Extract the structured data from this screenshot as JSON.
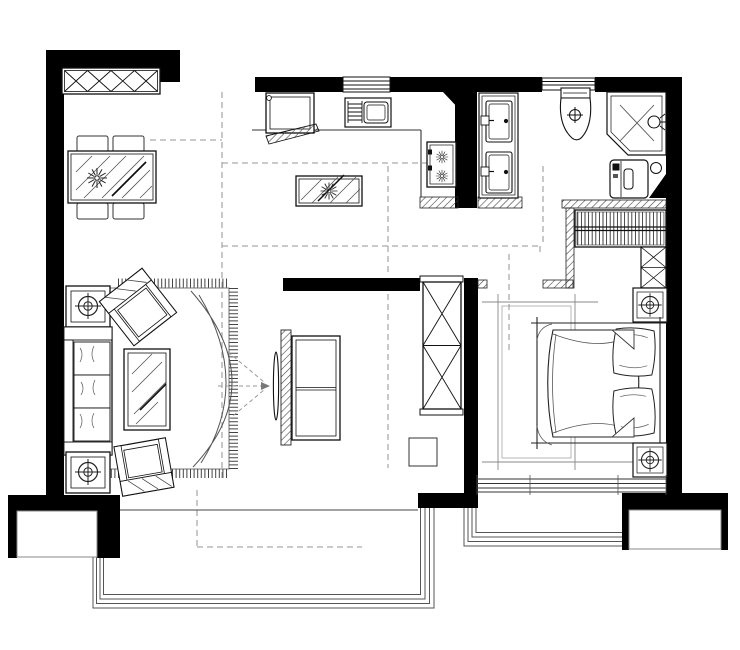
{
  "meta": {
    "title": "two-bedroom-apartment-floor-plan",
    "image_type": "black-and-white-cad-floor-plan",
    "canvas_width": 740,
    "canvas_height": 650,
    "visible_text": "none"
  },
  "palette": {
    "background": "#ffffff",
    "wall_fill": "#000000",
    "line": "#1a1a1a",
    "thin_line": "#666666",
    "dashed_guide": "#aaaaaa",
    "hatch": "#444444"
  },
  "rooms": {
    "dining_area": {
      "name": "dining-area",
      "furniture": [
        "wall-cabinet-x-panels",
        "glass-dining-table",
        "dining-chair x4",
        "potted-plant"
      ]
    },
    "kitchen": {
      "name": "kitchen",
      "furniture": [
        "refrigerator-open-door",
        "sink-with-drainboard",
        "window-over-sink",
        "l-shaped-counter",
        "two-burner-cooktop",
        "island-table-with-plant"
      ]
    },
    "bathroom": {
      "name": "bathroom",
      "furniture": [
        "double-sink-vanity",
        "toilet",
        "window-over-toilet",
        "corner-shower-enclosure",
        "washing-machine",
        "floor-drain",
        "corner-triangle-shelf"
      ]
    },
    "hallway": {
      "name": "hallway",
      "furniture": [
        "tall-x-front-cabinet",
        "stool"
      ]
    },
    "living_room": {
      "name": "living-room",
      "furniture": [
        "three-seat-sofa",
        "side-table-with-plant x2",
        "rotated-armchair",
        "second-armchair",
        "glass-coffee-table",
        "fringed-area-rug",
        "decorative-arc-motif",
        "tv-feature-wall-panel",
        "wall-mounted-tv",
        "tv-cabinet",
        "viewing-angle-guide-arrows"
      ]
    },
    "bedroom": {
      "name": "bedroom",
      "furniture": [
        "hanging-rail-wardrobe",
        "x-front-cabinet",
        "nightstand-with-lamp x2",
        "double-bed-with-pillows",
        "bedside-rug",
        "south-window"
      ]
    },
    "balconies": {
      "name": "balconies",
      "items": [
        "living-room-balcony-railing",
        "bedroom-balcony-railing",
        "ac-platform-west",
        "ac-platform-east"
      ]
    }
  },
  "annotations": {
    "ceiling_drop_guides": "gray-dashed-lines",
    "wall_hatching": "diagonal-hatch-light-partitions",
    "rug_fringe": "tick-marks"
  }
}
